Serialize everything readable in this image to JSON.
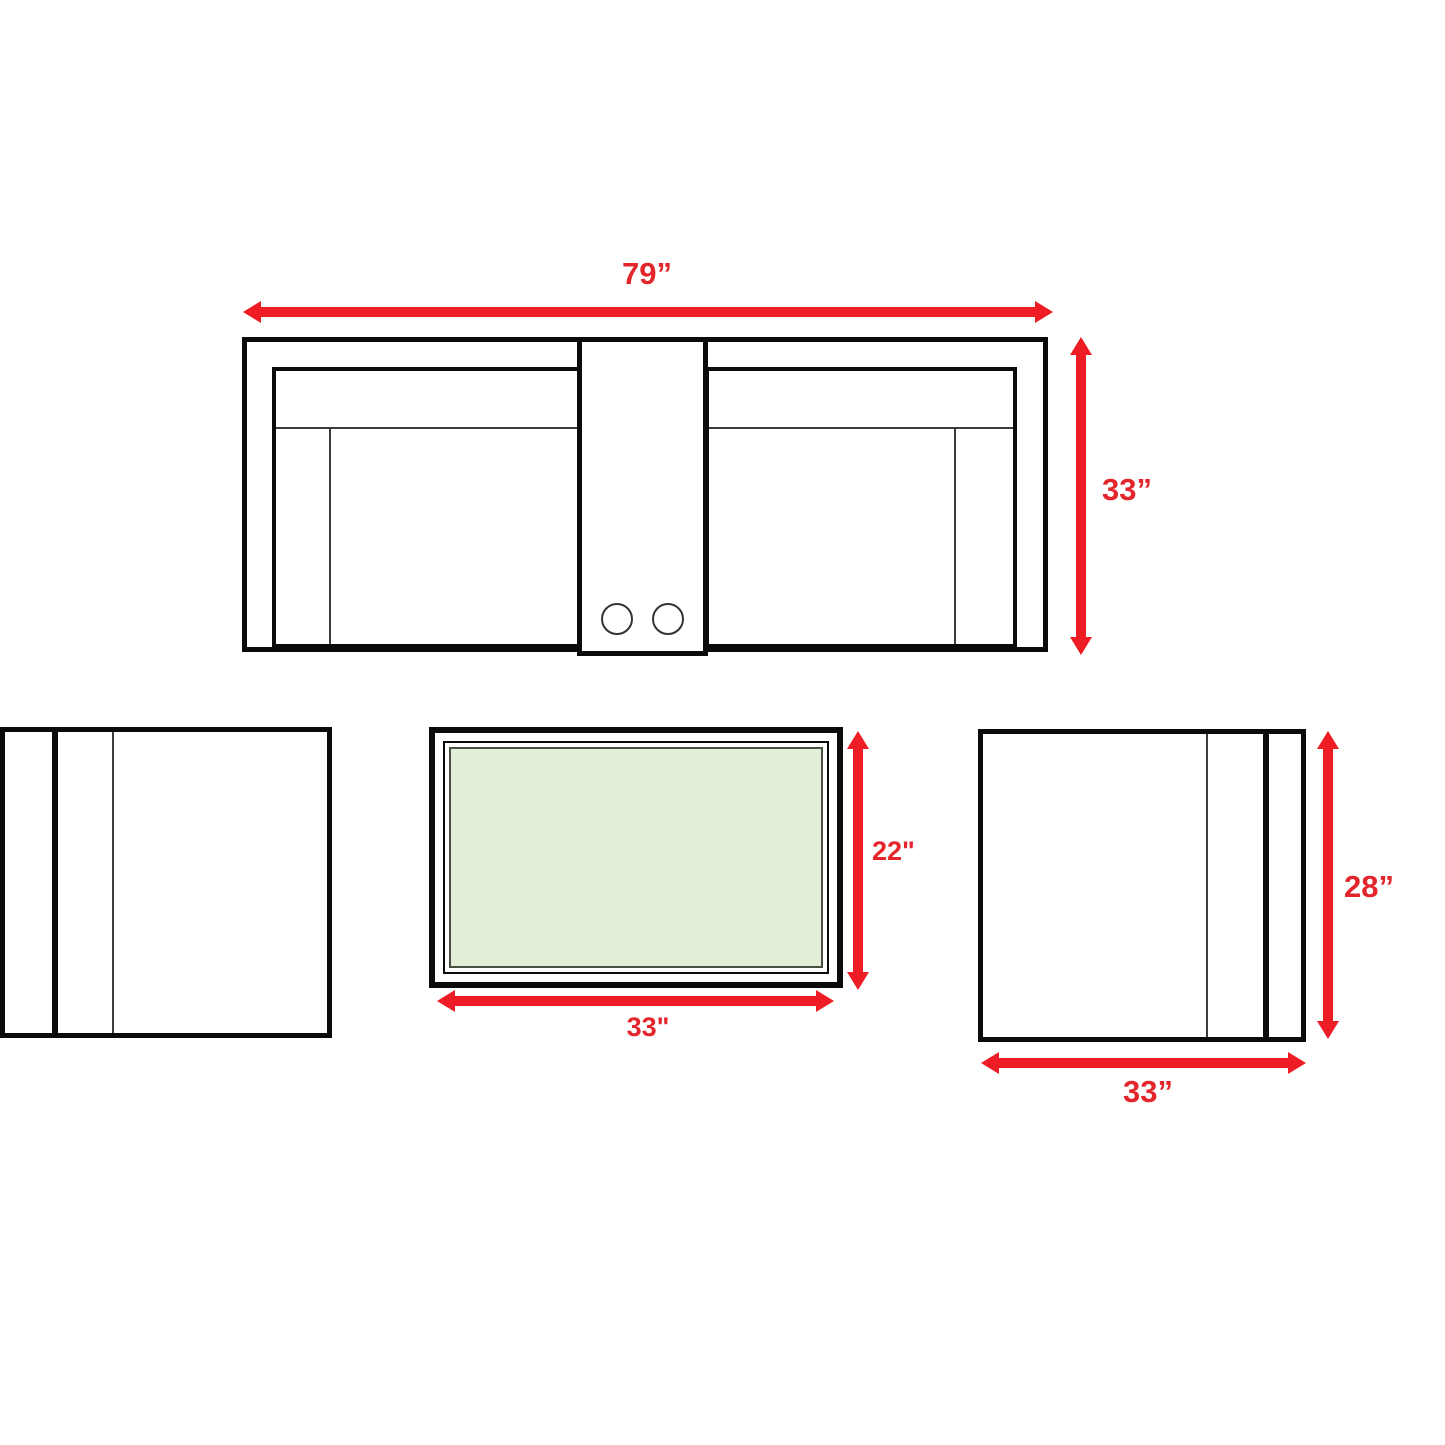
{
  "diagram_title": "Sofa set dimension drawing",
  "units": "inches",
  "colors": {
    "arrow_red": "#ee1c24",
    "label_red": "#e2262c",
    "outline_black": "#0b0b0b",
    "table_glass_green": "#e2eed8",
    "background_white": "#ffffff"
  },
  "sofa": {
    "name": "loveseat-with-center-console-top-view",
    "width_label": "79”",
    "depth_label": "33”",
    "cupholder_count": 2
  },
  "coffee_table": {
    "name": "coffee-table-top-view",
    "depth_label": "22\"",
    "width_label": "33\""
  },
  "armchair_right": {
    "name": "armchair-top-view",
    "depth_label": "28”",
    "width_label": "33”"
  },
  "armchair_left": {
    "name": "armchair-top-view-mirrored"
  }
}
